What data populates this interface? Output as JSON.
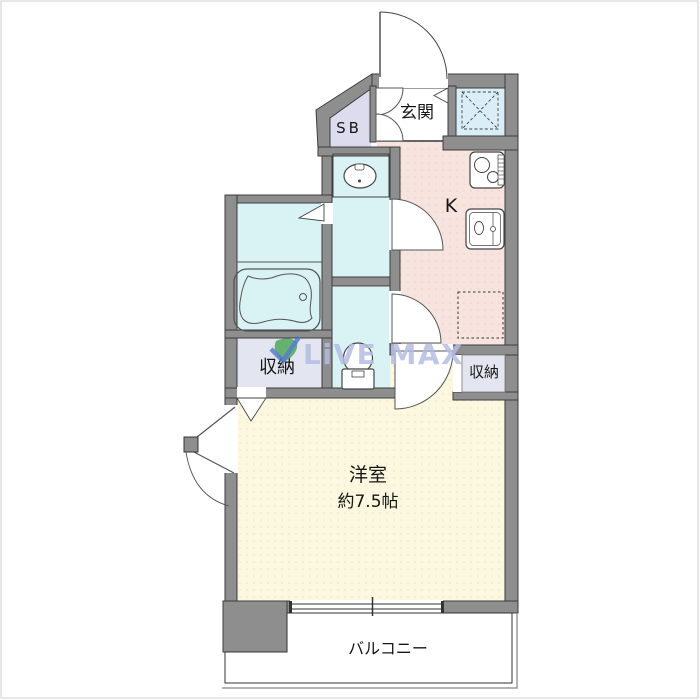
{
  "plan": {
    "type": "apartment-floor-plan",
    "rooms": {
      "entrance": {
        "label": "玄関"
      },
      "shoe_box": {
        "label": "SB"
      },
      "kitchen": {
        "label": "K"
      },
      "storage_left": {
        "label": "収納"
      },
      "storage_right": {
        "label": "収納"
      },
      "main_room": {
        "label": "洋室",
        "size": "約7.5帖"
      },
      "balcony": {
        "label": "バルコニー"
      }
    },
    "fixtures": [
      "entrance-door",
      "shoe-box-double-doors",
      "pipe-space-hatch",
      "stove",
      "kitchen-sink",
      "refrigerator-space",
      "washbasin",
      "bathtub",
      "toilet",
      "bath-folding-door",
      "closet-folding-door",
      "casement-window",
      "sliding-window"
    ],
    "watermark": {
      "text": "LiVE MAX"
    },
    "colors": {
      "wall": "#8e8e8e",
      "wet_room": "#d9f2f3",
      "kitchen": "#f8e4de",
      "main_room": "#fbf8df",
      "storage": "#e3e6f0",
      "shoe_box": "#dcdcee",
      "pipe_space": "#d9eef6",
      "watermark_text": "#b5bde5",
      "watermark_leaf_green": "#3fa14c",
      "watermark_leaf_blue": "#4a72cc"
    }
  }
}
